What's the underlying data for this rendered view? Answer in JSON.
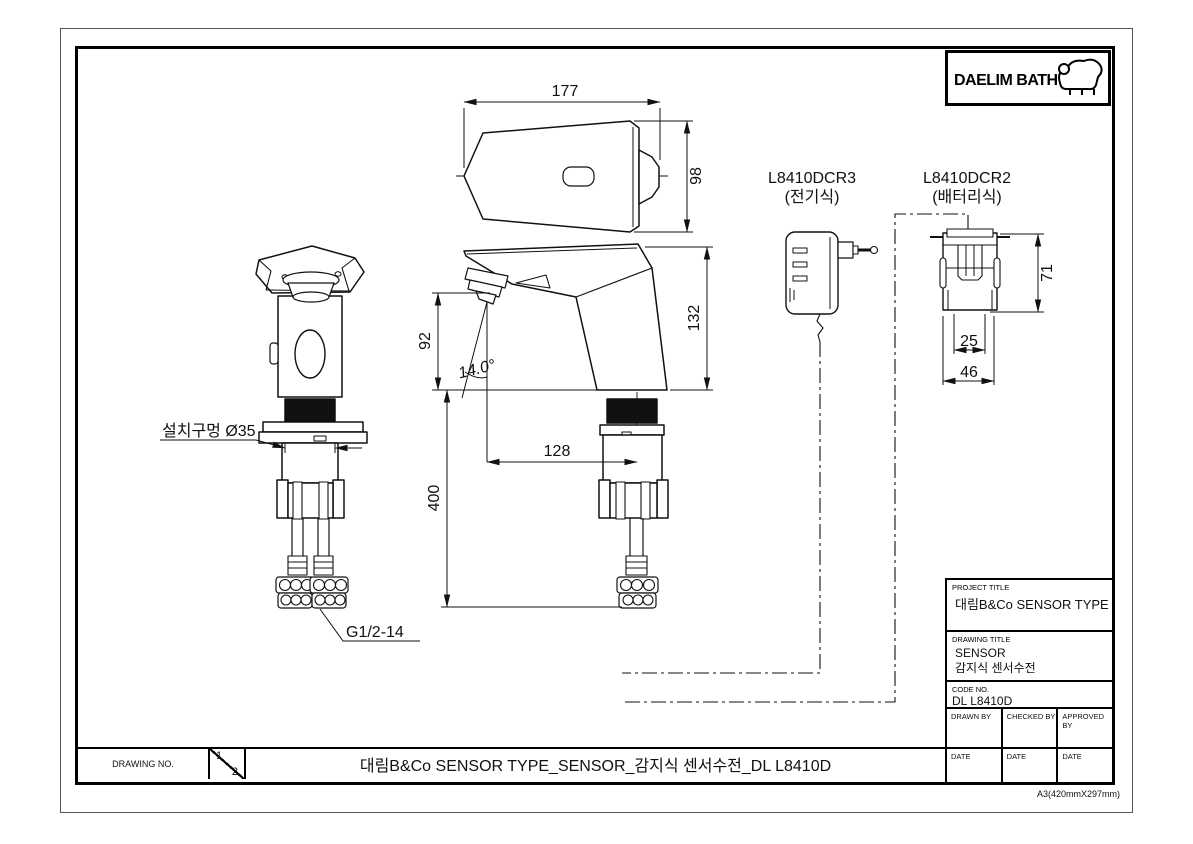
{
  "logo": {
    "brand": "DAELIM BATH"
  },
  "views": {
    "top": {
      "width": "177",
      "depth": "98"
    },
    "side": {
      "spout_height": "92",
      "angle": "14.0°",
      "total_height": "132",
      "reach": "128",
      "inlet_length": "400"
    },
    "front": {
      "mount_hole": "설치구멍 Ø35",
      "thread": "G1/2-14"
    },
    "adapter": {
      "model": "L8410DCR3",
      "type": "(전기식)"
    },
    "battery": {
      "model": "L8410DCR2",
      "type": "(배터리식)",
      "height": "71",
      "inner_width": "25",
      "width": "46"
    }
  },
  "title_block": {
    "project_title_label": "PROJECT TITLE",
    "project_title": "대림B&Co SENSOR TYPE",
    "drawing_title_label": "DRAWING TITLE",
    "drawing_title_line1": "SENSOR",
    "drawing_title_line2": "감지식 센서수전",
    "code_no_label": "CODE NO.",
    "code_no": "DL L8410D",
    "drawn_by_label": "DRAWN BY",
    "checked_by_label": "CHECKED BY",
    "approved_by_label": "APPROVED BY",
    "date_label_1": "DATE",
    "date_label_2": "DATE",
    "date_label_3": "DATE"
  },
  "bottom_bar": {
    "drawing_no_label": "DRAWING NO.",
    "sheet_current": "1",
    "sheet_total": "2",
    "title": "대림B&Co SENSOR TYPE_SENSOR_감지식 센서수전_DL L8410D"
  },
  "page": {
    "paper_note": "A3(420mmX297mm)"
  },
  "colors": {
    "line": "#111111",
    "paper": "#ffffff"
  }
}
